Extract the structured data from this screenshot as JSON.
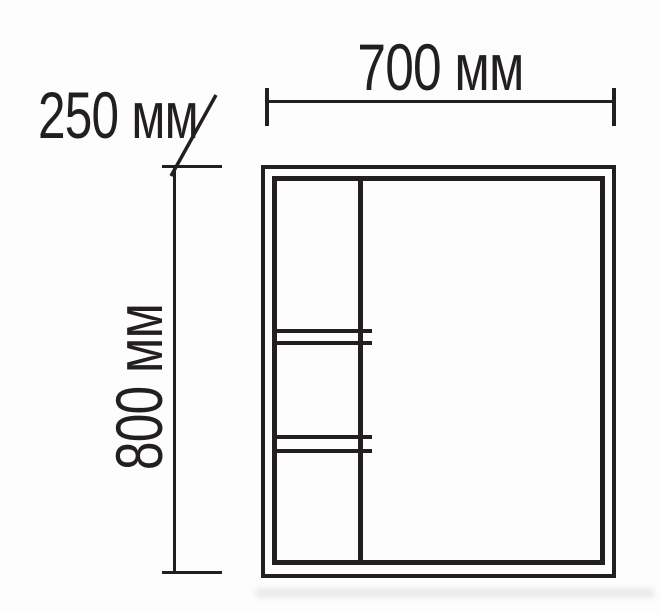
{
  "diagram": {
    "labels": {
      "width": "700 мм",
      "height": "800 мм",
      "depth": "250 мм"
    },
    "values_mm": {
      "width": 700,
      "height": 800,
      "depth": 250
    },
    "colors": {
      "line": "#231f20",
      "background": "#fdfdfd"
    }
  }
}
